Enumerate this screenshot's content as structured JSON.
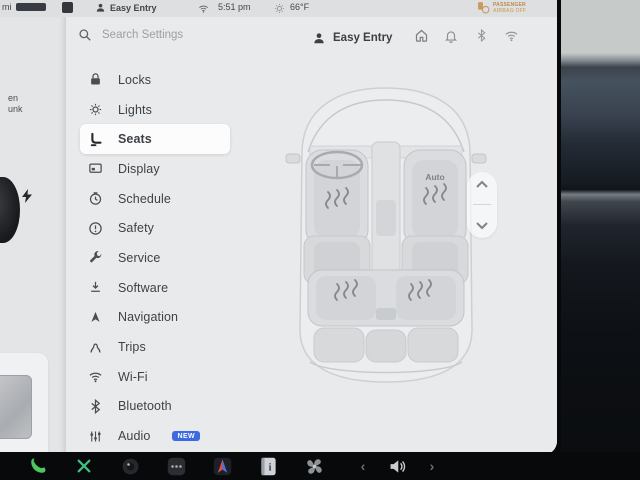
{
  "status_bar": {
    "range_unit": "mi",
    "profile": "Easy Entry",
    "time": "5:51 pm",
    "temperature": "66°F",
    "airbag_line1": "PASSENGER",
    "airbag_line2": "AIRBAG OFF"
  },
  "underlay": {
    "cut_line1": "en",
    "cut_line2": "unk"
  },
  "settings": {
    "search_placeholder": "Search Settings",
    "profile": "Easy Entry",
    "sidebar": {
      "items": [
        {
          "icon": "lock-icon",
          "label": "Locks"
        },
        {
          "icon": "lights-icon",
          "label": "Lights"
        },
        {
          "icon": "seat-icon",
          "label": "Seats",
          "selected": true
        },
        {
          "icon": "display-icon",
          "label": "Display"
        },
        {
          "icon": "schedule-icon",
          "label": "Schedule"
        },
        {
          "icon": "safety-icon",
          "label": "Safety"
        },
        {
          "icon": "service-icon",
          "label": "Service"
        },
        {
          "icon": "software-icon",
          "label": "Software"
        },
        {
          "icon": "navigation-icon",
          "label": "Navigation"
        },
        {
          "icon": "trips-icon",
          "label": "Trips"
        },
        {
          "icon": "wifi-icon",
          "label": "Wi-Fi"
        },
        {
          "icon": "bluetooth-icon",
          "label": "Bluetooth"
        },
        {
          "icon": "audio-icon",
          "label": "Audio",
          "badge": "NEW"
        }
      ]
    },
    "seat_diagram": {
      "front_passenger_mode": "Auto",
      "heated_seats": [
        "front-left",
        "front-right",
        "rear-left",
        "rear-right"
      ]
    }
  },
  "taskbar": {
    "icons": [
      "phone-icon",
      "x-app-icon",
      "camera-icon",
      "apps-dots-icon",
      "nav-arrow-icon",
      "manual-icon",
      "fan-icon"
    ],
    "volume_prev": "‹",
    "volume_next": "›"
  },
  "colors": {
    "panel_bg": "#e9eaec",
    "selected_pill": "#fcfcfd",
    "badge_blue": "#3d69e1",
    "phone_green": "#4cc75e",
    "airbag_orange": "#bc8a4e"
  }
}
